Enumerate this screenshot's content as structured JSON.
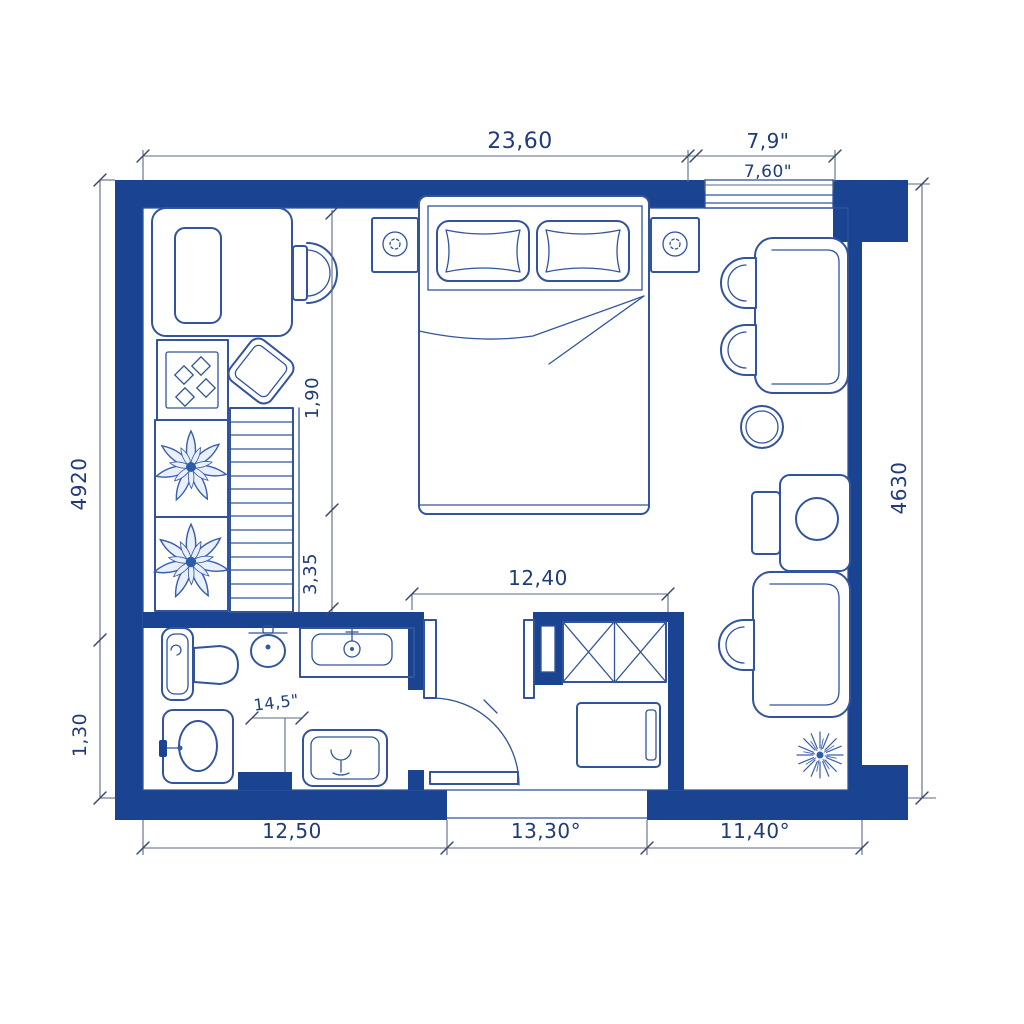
{
  "drawing": {
    "kind": "apartment floor plan (blueprint sketch)",
    "colors": {
      "wall_blue": "#1a4391",
      "line_blue": "#31549c",
      "dim_text": "#1f3b78",
      "background": "#ffffff"
    }
  },
  "dims": {
    "top_main": "23,60",
    "top_window": "7,9\"",
    "top_window_inner": "7,60\"",
    "left_upper": "4920",
    "left_lower": "1,30",
    "right_side": "4630",
    "bottom_left": "12,50",
    "bottom_center": "13,30°",
    "bottom_right": "11,40°",
    "interior_upper": "1,90",
    "interior_lower": "3,35",
    "hallway_width": "12,40",
    "bathroom_detail": "14,5\""
  },
  "icons": [
    "double-bed",
    "pillow",
    "nightstand-lamp",
    "desk",
    "desk-chair",
    "stove-hob",
    "stool",
    "potted-plant",
    "staircase",
    "toilet",
    "pedestal-sink",
    "vanity-sink",
    "washbasin",
    "shower-tray",
    "wardrobe-x",
    "doormat",
    "dining-table",
    "half-round-chair",
    "round-stool",
    "work-desk",
    "coffee-table",
    "dandelion-plant",
    "entry-door-swing",
    "window-opening"
  ]
}
